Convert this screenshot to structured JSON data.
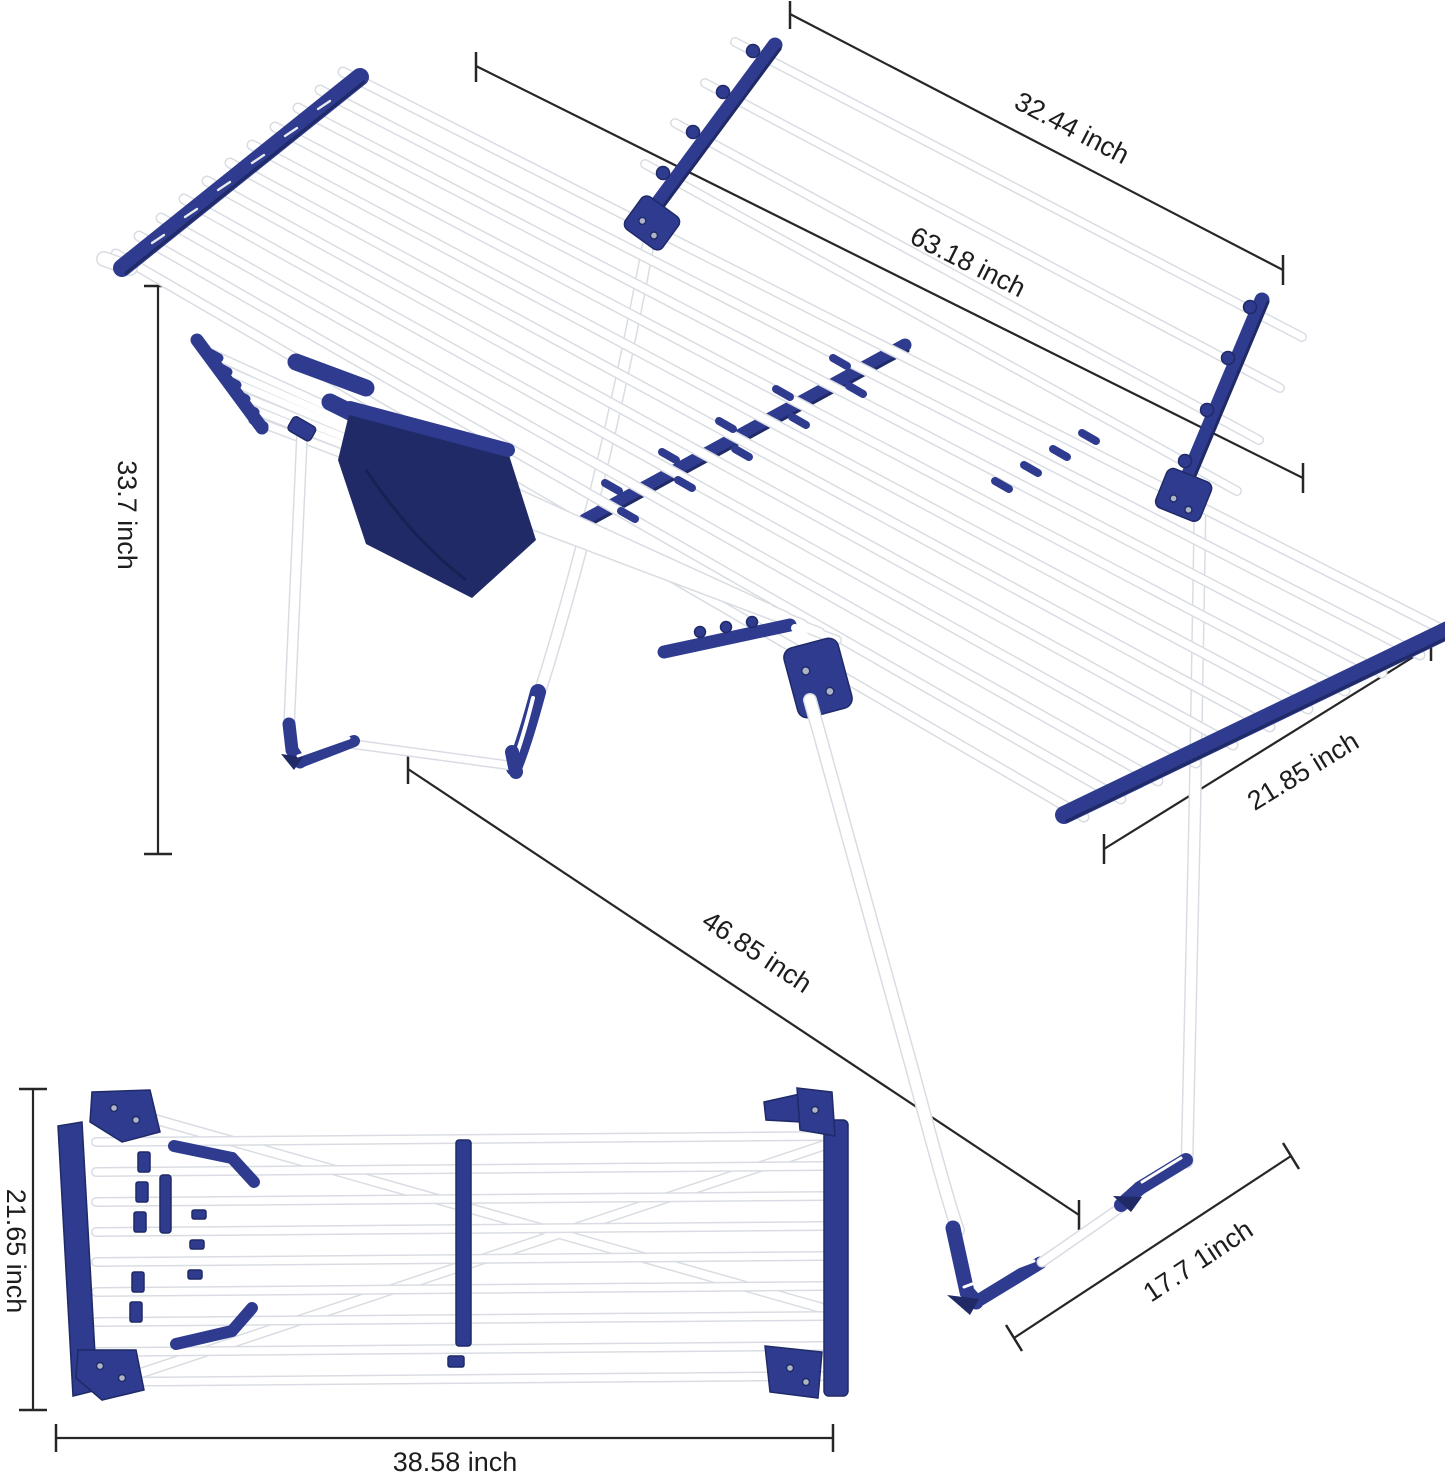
{
  "colors": {
    "navy": "#2e3b8f",
    "navy_dark": "#1f2a66",
    "rod_white": "#ffffff",
    "rod_outline": "#d9dde3",
    "dimension_line": "#262626",
    "text": "#1d1d1d",
    "background": "#ffffff"
  },
  "dimensions": {
    "wing_length": {
      "label": "32.44 inch"
    },
    "total_length": {
      "label": "63.18 inch"
    },
    "stand_height": {
      "label": "33.7 inch"
    },
    "deck_width": {
      "label": "21.85 inch"
    },
    "floor_diagonal": {
      "label": "46.85 inch"
    },
    "foot_depth": {
      "label": "17.7 1inch"
    },
    "folded_width": {
      "label": "21.65 inch"
    },
    "folded_length": {
      "label": "38.58 inch"
    }
  }
}
